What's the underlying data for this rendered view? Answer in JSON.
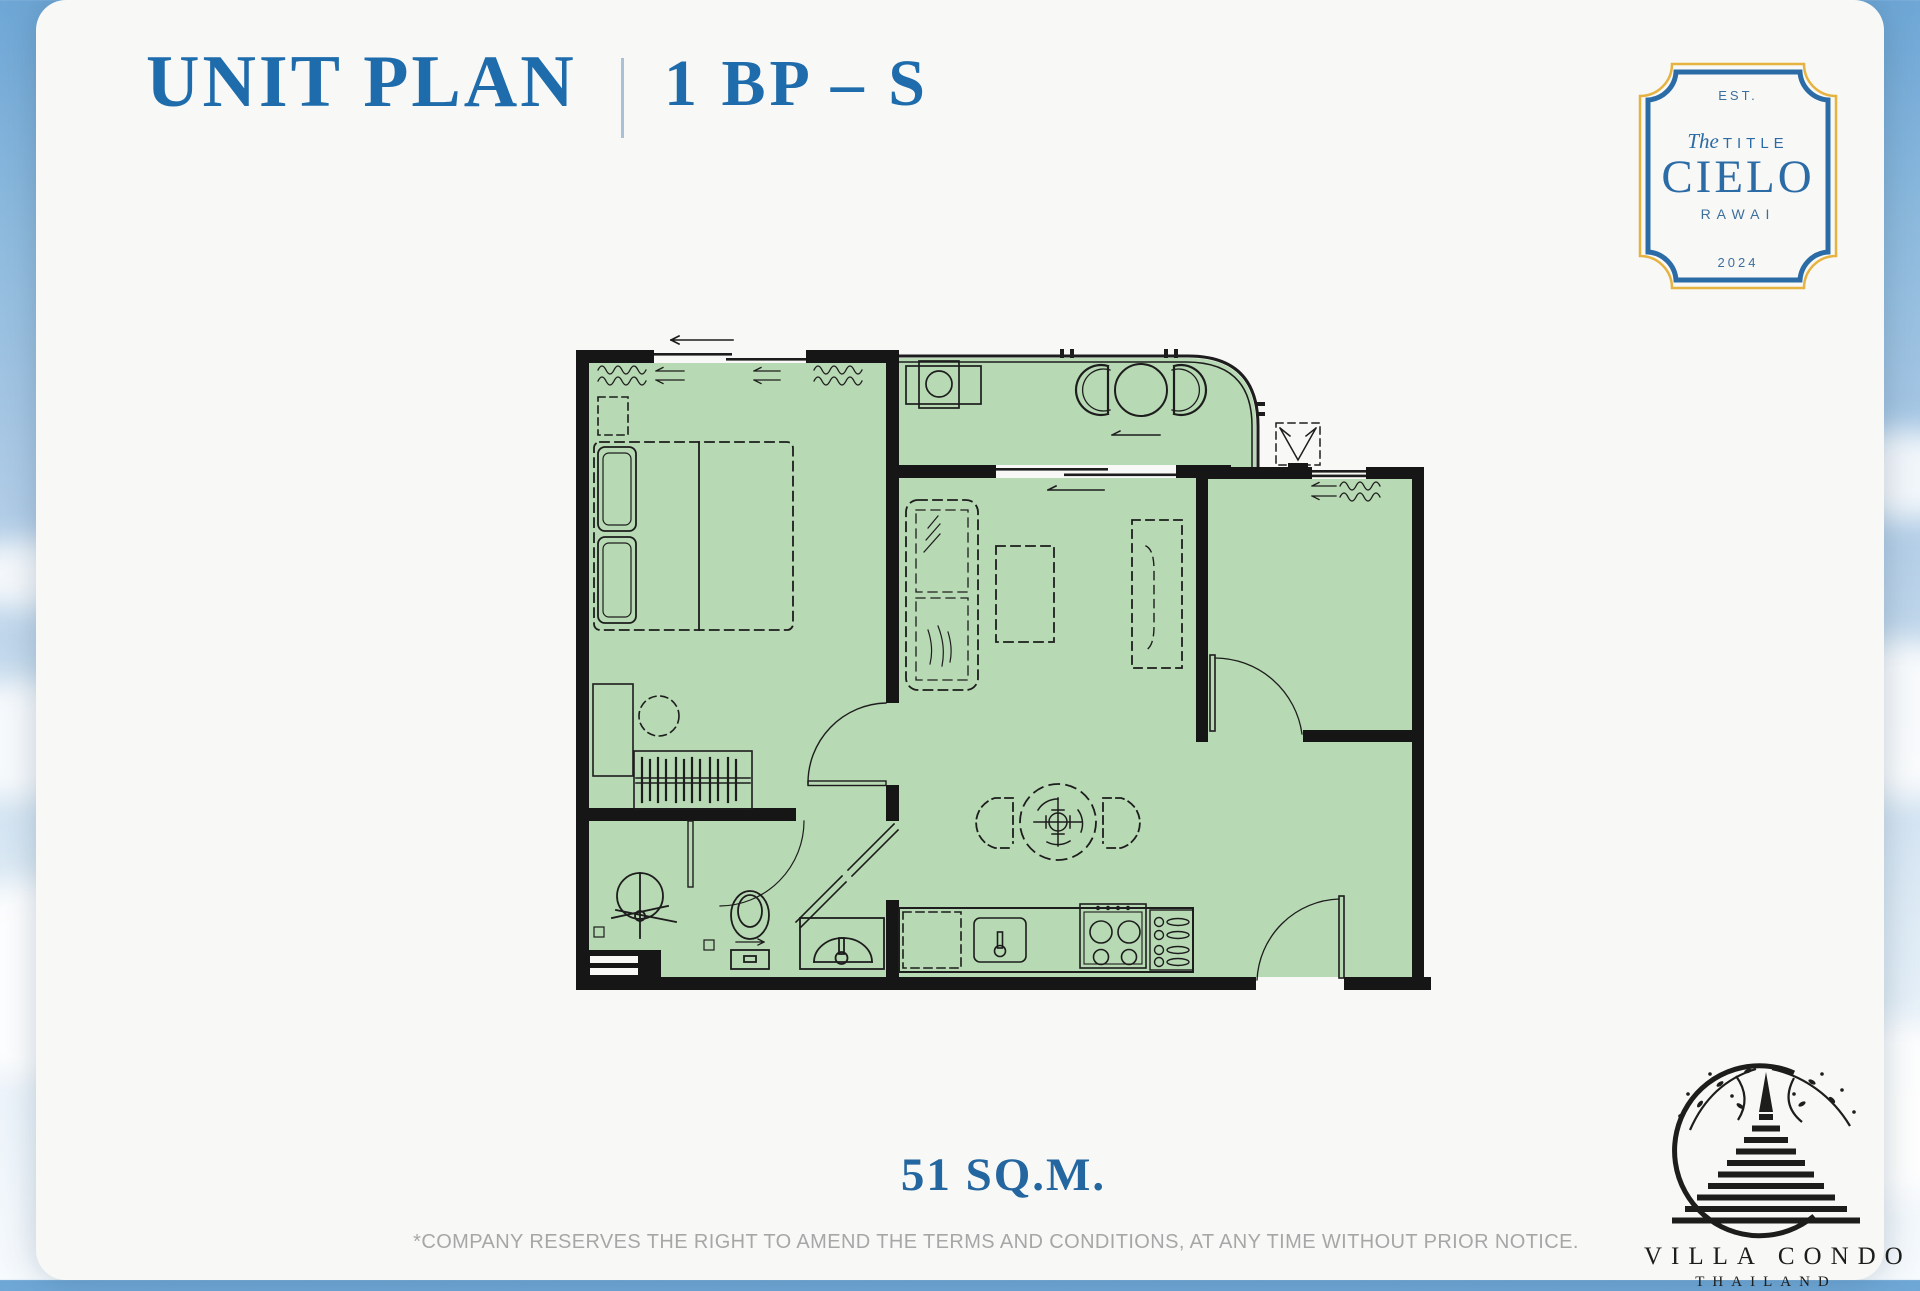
{
  "header": {
    "title": "UNIT PLAN",
    "unit_code": "1 BP – S"
  },
  "badge": {
    "est": "EST.",
    "the": "The",
    "title_word": "TITLE",
    "name": "CIELO",
    "location": "RAWAI",
    "year": "2024"
  },
  "plan": {
    "area_label": "51 SQ.M.",
    "rooms": [
      "bedroom",
      "living-dining",
      "kitchen",
      "bathroom",
      "balcony",
      "multipurpose-room"
    ]
  },
  "footer": {
    "disclaimer": "*COMPANY RESERVES THE RIGHT TO AMEND THE TERMS AND CONDITIONS,  AT ANY TIME WITHOUT PRIOR NOTICE."
  },
  "brand": {
    "name": "VILLA CONDO",
    "country": "THAILAND"
  },
  "colors": {
    "title_blue": "#1e6cab",
    "badge_blue": "#2b6ba6",
    "badge_gold": "#e6b340",
    "plan_green": "#b7d9b3",
    "wall_black": "#161616",
    "disclaimer_gray": "#a7a7a7"
  }
}
